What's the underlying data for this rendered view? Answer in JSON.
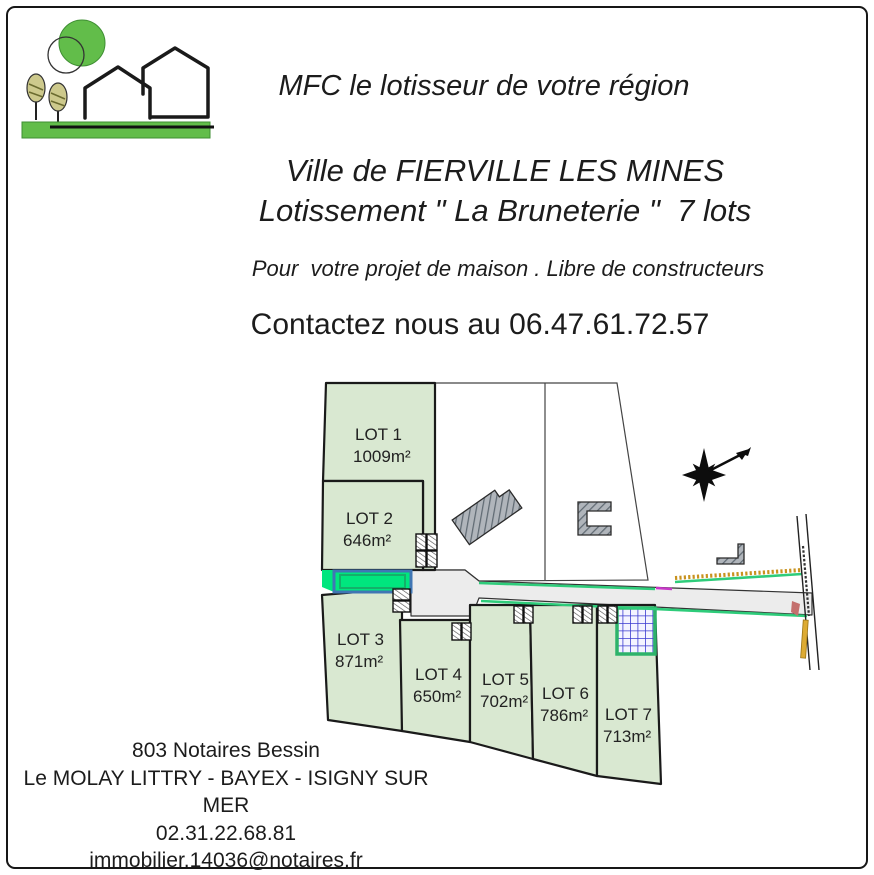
{
  "theme": {
    "ink": "#1c1c1c",
    "logo-green": "#62bd4a",
    "logo-green-dark": "#3f8f33",
    "tree-olive": "#cdc98c",
    "lot-fill": "#d9e8d1",
    "lot-stroke": "#1a1a1a",
    "road-fill": "#ececec",
    "spring-green": "#00e67e",
    "edge-green": "#2ecc7a",
    "steel-blue": "#4076b4",
    "inner-teal": "#14b06a",
    "basin-line": "#3b3bd0",
    "basin-border": "#2db36a",
    "hedge-orange": "#c8921e",
    "bar-yellow": "#ddab33",
    "mark-pink": "#c4706e",
    "magenta": "#c837c8",
    "building-gray": "#b0b5bb",
    "building-hatch": "#606a73"
  },
  "header": {
    "tagline": "MFC le lotisseur de votre région",
    "title_line1": "Ville de FIERVILLE LES MINES",
    "title_line2": "Lotissement \" La Bruneterie \"  7 lots",
    "subtitle": "Pour  votre projet de maison . Libre de constructeurs",
    "contact": "Contactez nous au 06.47.61.72.57"
  },
  "plan": {
    "lots": [
      {
        "name": "LOT 1",
        "area": "1009m²"
      },
      {
        "name": "LOT 2",
        "area": "646m²"
      },
      {
        "name": "LOT 3",
        "area": "871m²"
      },
      {
        "name": "LOT 4",
        "area": "650m²"
      },
      {
        "name": "LOT 5",
        "area": "702m²"
      },
      {
        "name": "LOT 6",
        "area": "786m²"
      },
      {
        "name": "LOT 7",
        "area": "713m²"
      }
    ]
  },
  "footer": {
    "lines": [
      "803 Notaires Bessin",
      "Le MOLAY LITTRY - BAYEX - ISIGNY SUR MER",
      "02.31.22.68.81",
      "immobilier.14036@notaires.fr"
    ]
  }
}
